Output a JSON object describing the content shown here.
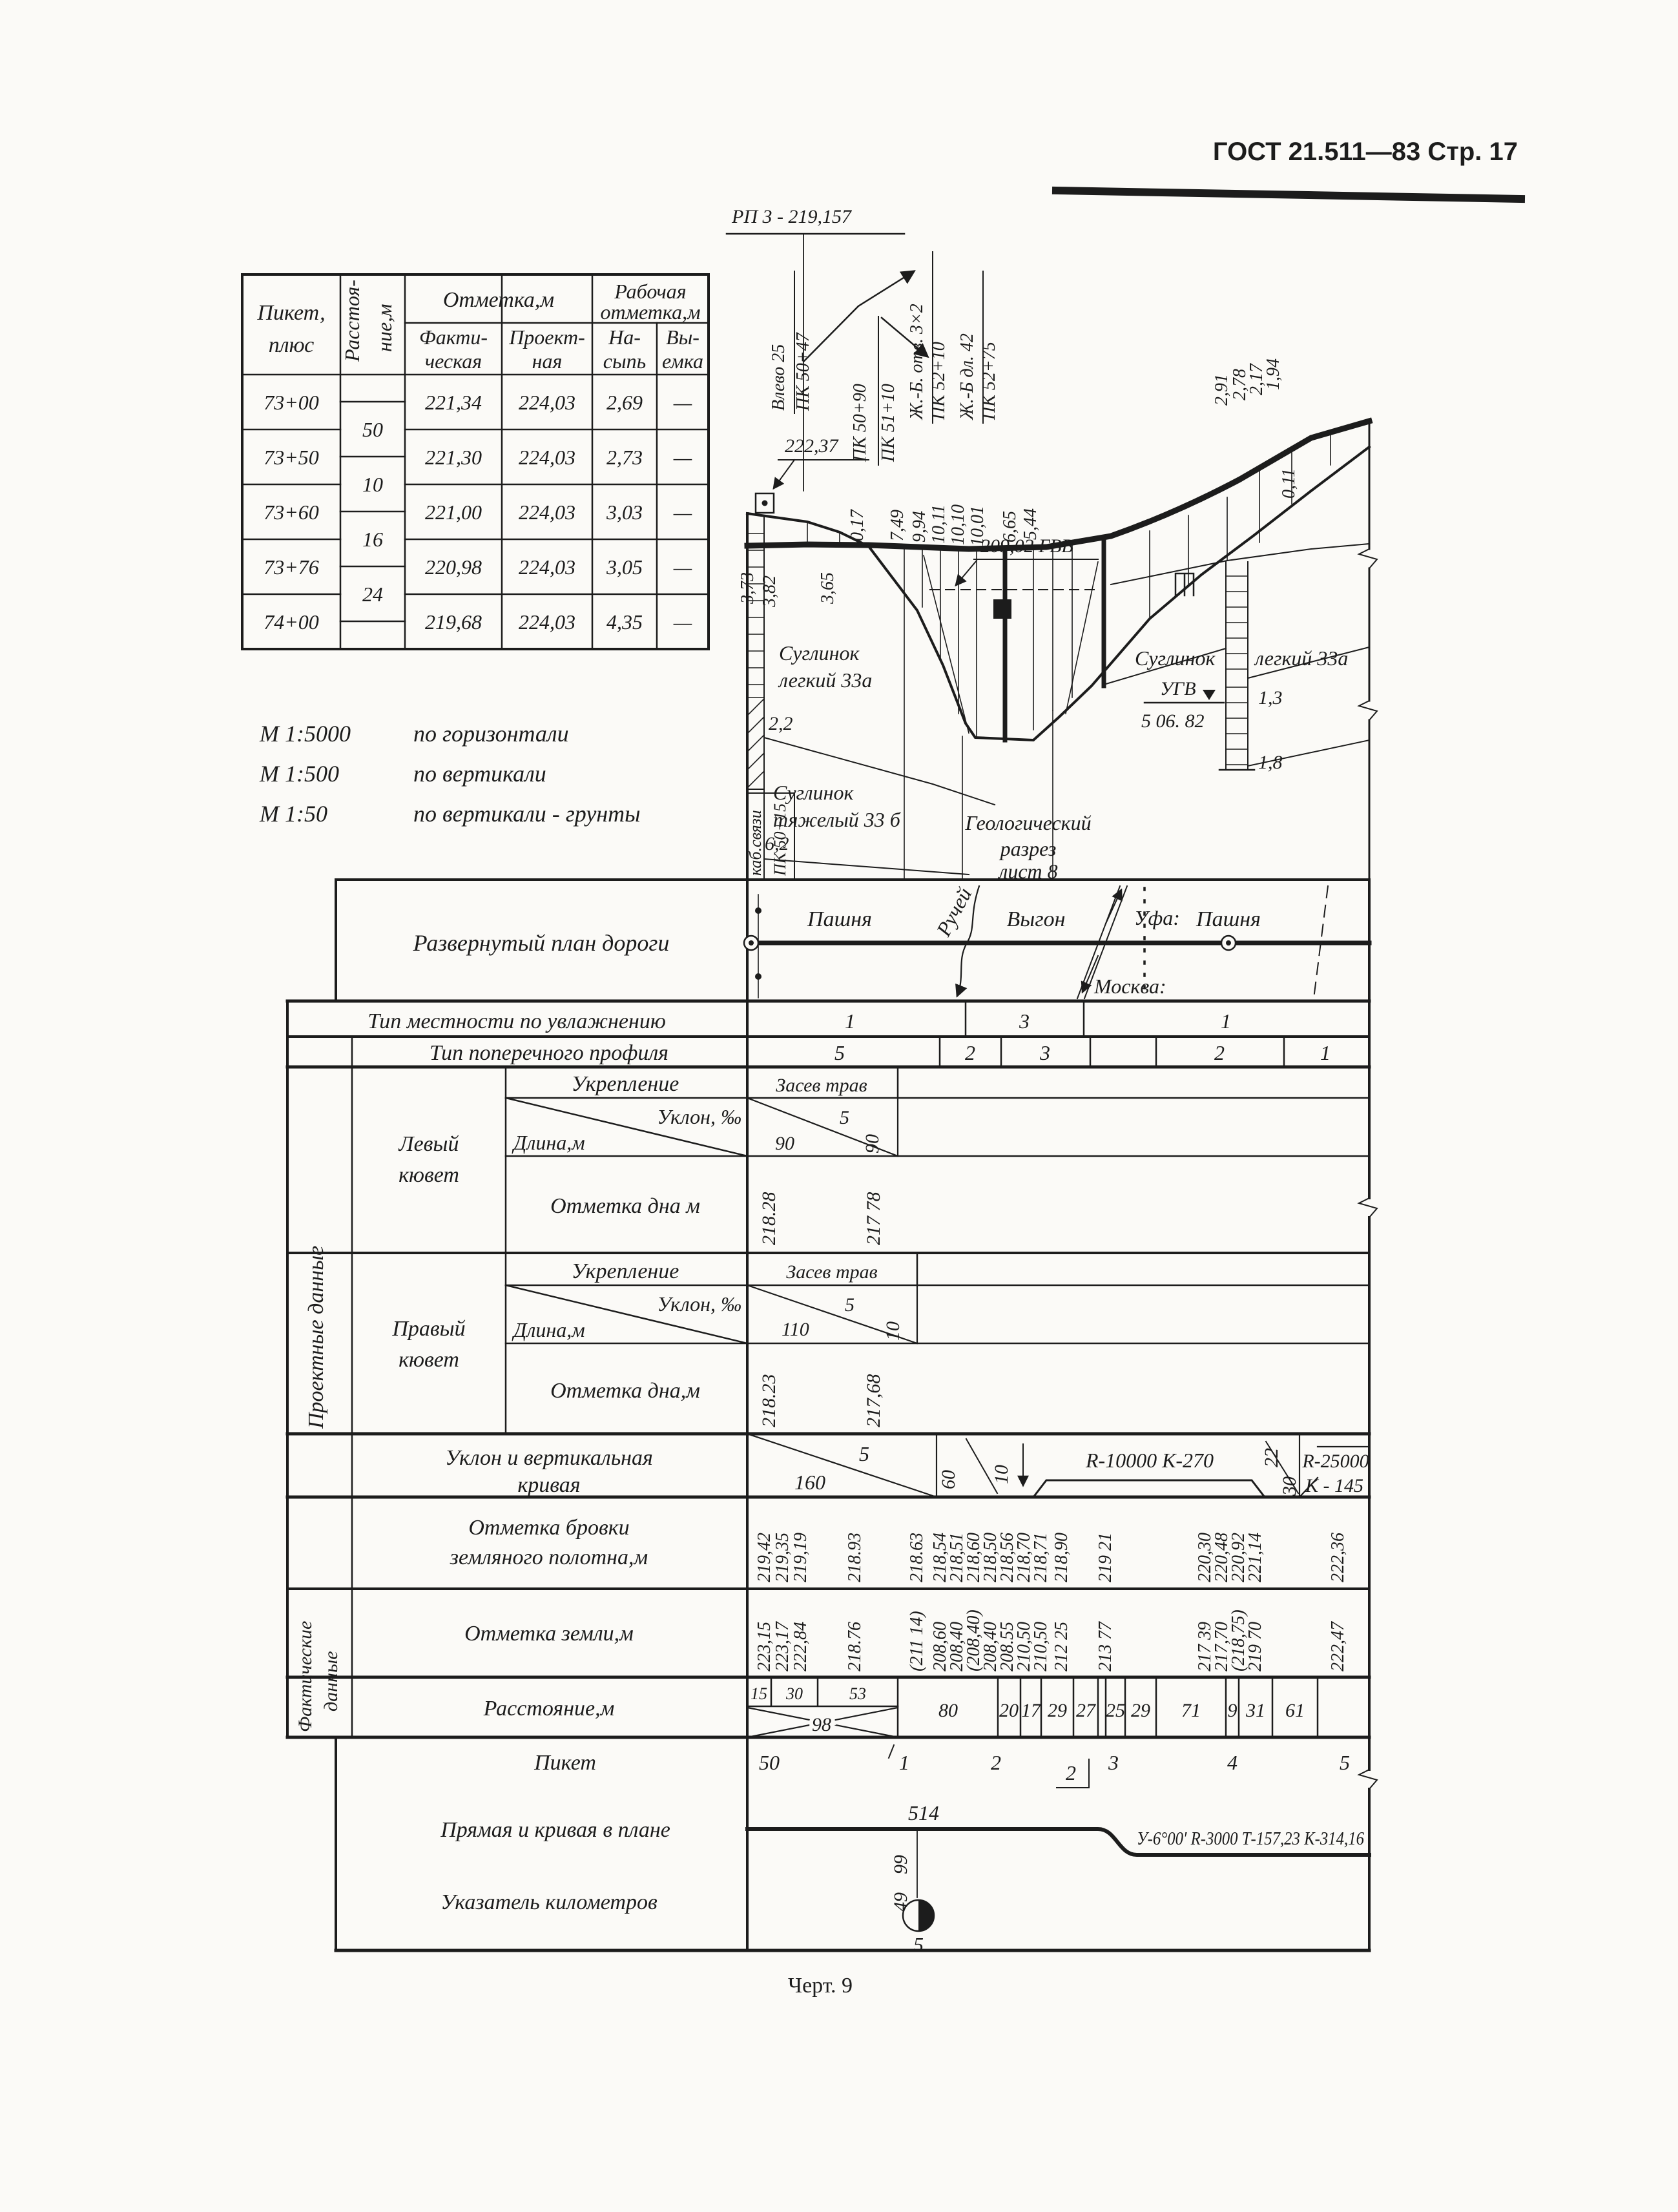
{
  "page": {
    "header": "ГОСТ 21.511—83  Стр. 17",
    "caption": "Черт. 9"
  },
  "elev": {
    "h_pk1": "Пикет,",
    "h_pk2": "плюс",
    "h_dist1": "Расстоя-",
    "h_dist2": "ние,м",
    "h_mark": "Отметка,м",
    "h_fact1": "Факти-",
    "h_fact2": "ческая",
    "h_proj1": "Проект-",
    "h_proj2": "ная",
    "h_work1": "Рабочая",
    "h_work2": "отметка,м",
    "h_fill1": "На-",
    "h_fill2": "сыпь",
    "h_cut1": "Вы-",
    "h_cut2": "емка",
    "rows": [
      {
        "pk": "73+00",
        "f": "221,34",
        "d": "224,03",
        "n": "2,69",
        "v": "—"
      },
      {
        "pk": "73+50",
        "f": "221,30",
        "d": "224,03",
        "n": "2,73",
        "v": "—"
      },
      {
        "pk": "73+60",
        "f": "221,00",
        "d": "224,03",
        "n": "3,03",
        "v": "—"
      },
      {
        "pk": "73+76",
        "f": "220,98",
        "d": "224,03",
        "n": "3,05",
        "v": "—"
      },
      {
        "pk": "74+00",
        "f": "219,68",
        "d": "224,03",
        "n": "4,35",
        "v": "—"
      }
    ],
    "dist": [
      "50",
      "10",
      "16",
      "24"
    ]
  },
  "scales": {
    "m1": "М 1:5000",
    "t1": "по горизонтали",
    "m2": "М 1:500",
    "t2": "по вертикали",
    "m3": "М 1:50",
    "t3": "по вертикали - грунты"
  },
  "prof": {
    "rp": "РП 3 - 219,157",
    "rp_elev": "222,37",
    "vlevo": "Влево 25",
    "vlevo_pk": "ПК 50+47",
    "pk5090": "ПК 50+90",
    "pk5110": "ПК 51+10",
    "culvert": "Ж.-Б. отв. 3×2",
    "culvert_pk": "ПК 52+10",
    "bridge": "Ж.-Б дл. 42",
    "bridge_pk": "ПК 52+75",
    "gvv": "209,02 ГВВ",
    "wl": [
      "3,73",
      "3,82",
      "3,65"
    ],
    "wm": [
      "0,17",
      "7,49",
      "9,94",
      "10,11",
      "10,10",
      "10,01",
      "6,65",
      "5,44",
      "2,91",
      "2,78",
      "2,17",
      "1,94",
      "0,11"
    ],
    "soil1a": "Суглинок",
    "soil1b": "легкий 33а",
    "d22": "2,2",
    "soil2a": "Суглинок",
    "soil2b": "тяжелый 33 б",
    "d62": "6,2",
    "geo1": "Геологический",
    "geo2": "разрез",
    "geo3": "лист 8",
    "soil3a": "Суглинок",
    "soil3b": "легкий 33а",
    "ugv": "УГВ",
    "ugv_date": "5 06. 82",
    "d13": "1,3",
    "d18": "1,8",
    "cable": "каб.связи",
    "cable_pk": "ПК 50+15"
  },
  "grid": {
    "plan_label": "Развернутый план дороги",
    "plan": {
      "pashnya1": "Пашня",
      "ruchey": "Ручей",
      "vygon": "Выгон",
      "ufa": "Уфа:",
      "moskva": "Москва:",
      "pashnya2": "Пашня"
    },
    "terr_label": "Тип местности по увлажнению",
    "terr": [
      "1",
      "3",
      "1"
    ],
    "cross_label": "Тип поперечного профиля",
    "cross": [
      "5",
      "2",
      "3",
      "2",
      "1"
    ],
    "group_design": "Проектные данные",
    "group_actual1": "Фактические",
    "group_actual2": "данные",
    "ld1": "Левый",
    "ld2": "кювет",
    "rd1": "Правый",
    "rd2": "кювет",
    "reinforce": "Укрепление",
    "slope": "Уклон, ‰",
    "length": "Длина,м",
    "bottom_l": "Отметка дна м",
    "bottom_r": "Отметка дна,м",
    "ld": {
      "re": "Засев трав",
      "len": "90",
      "sl": "5",
      "sl2": "90",
      "b1": "218.28",
      "b2": "217 78"
    },
    "rd": {
      "re": "Засев трав",
      "len": "110",
      "sl": "5",
      "sl2": "10",
      "b1": "218.23",
      "b2": "217,68"
    },
    "grade_label1": "Уклон и вертикальная",
    "grade_label2": "кривая",
    "grade": {
      "v160": "160",
      "v5": "5",
      "v60": "60",
      "v10": "10",
      "r1": "R-10000  К-270",
      "v22": "22",
      "v30": "30",
      "r2": "R-25000",
      "k2": "К - 145"
    },
    "edge_label1": "Отметка бровки",
    "edge_label2": "земляного полотна,м",
    "edge": [
      "219,42",
      "219,35",
      "219,19",
      "218.93",
      "218.63",
      "218,54",
      "218,51",
      "218,60",
      "218,50",
      "218,56",
      "218,70",
      "218,71",
      "218,90",
      "219 21",
      "220,30",
      "220,48",
      "220,92",
      "221,14",
      "222,36"
    ],
    "ground_label": "Отметка земли,м",
    "ground": [
      "223,15",
      "223,17",
      "222,84",
      "218.76",
      "(211 14)",
      "208,60",
      "208,40",
      "(208,40)",
      "208,40",
      "208.55",
      "210,50",
      "210,50",
      "212 25",
      "213 77",
      "217 39",
      "217,70",
      "(218,75)",
      "219 70",
      "222,47"
    ],
    "dist_label": "Расстояние,м",
    "dist": [
      "15",
      "30",
      "53",
      "98",
      "80",
      "20",
      "17",
      "29",
      "27",
      "25",
      "29",
      "71",
      "9",
      "31",
      "61"
    ],
    "pk_label": "Пикет",
    "pk": [
      "50",
      "1",
      "2",
      "2",
      "3",
      "4",
      "5"
    ],
    "line_label": "Прямая и кривая в плане",
    "line": {
      "v514": "514",
      "v99": "99",
      "curve": "У-6°00′ R-3000 Т-157,23  К-314,16"
    },
    "km_label": "Указатель километров",
    "km": {
      "v49": "49",
      "v5": "5"
    }
  }
}
